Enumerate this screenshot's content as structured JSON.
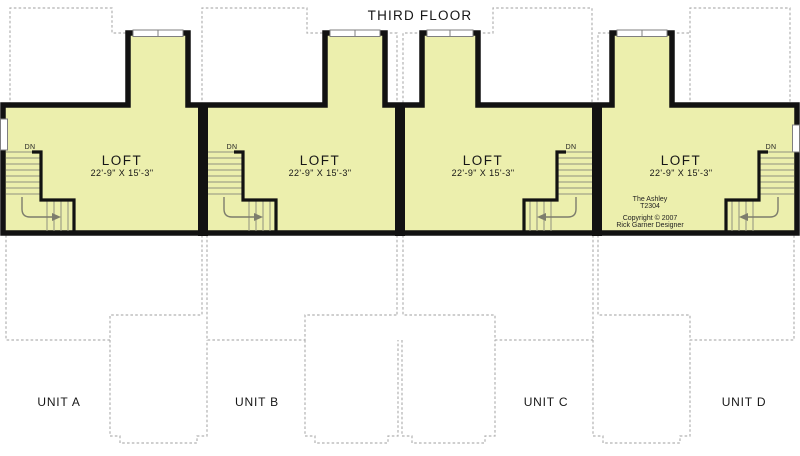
{
  "title": "THIRD FLOOR",
  "plan_info": {
    "name": "The Ashley",
    "code": "T2304",
    "copyright": "Copyright © 2007",
    "designer": "Rick Garner Designer"
  },
  "units": [
    {
      "id": "A",
      "label": "UNIT A",
      "room_label": "LOFT",
      "room_dimensions": "22'-9\" X 15'-3\"",
      "stair_label": "DN"
    },
    {
      "id": "B",
      "label": "UNIT B",
      "room_label": "LOFT",
      "room_dimensions": "22'-9\" X 15'-3\"",
      "stair_label": "DN"
    },
    {
      "id": "C",
      "label": "UNIT C",
      "room_label": "LOFT",
      "room_dimensions": "22'-9\" X 15'-3\"",
      "stair_label": "DN"
    },
    {
      "id": "D",
      "label": "UNIT D",
      "room_label": "LOFT",
      "room_dimensions": "22'-9\" X 15'-3\"",
      "stair_label": "DN"
    }
  ],
  "colors": {
    "loft_fill": "#ecefad",
    "wall": "#121212",
    "roofline_dash": "#b2b2b2",
    "stair_line": "#90907e",
    "window_frame": "#7f7f7f"
  }
}
